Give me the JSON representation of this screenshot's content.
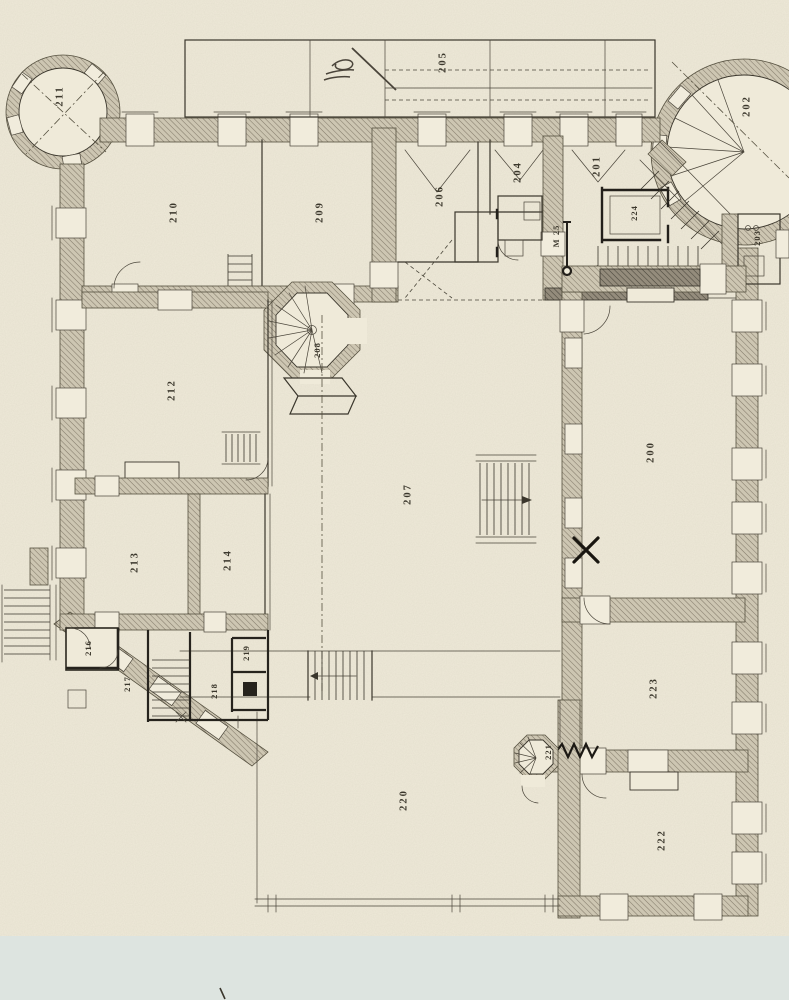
{
  "labels": {
    "r200": "200",
    "r201": "201",
    "r202": "202",
    "r203": "203",
    "r204": "204",
    "r205": "205",
    "r206": "206",
    "r207": "207",
    "r208": "208",
    "r209": "209",
    "r210": "210",
    "r211": "211",
    "r212": "212",
    "r213": "213",
    "r214": "214",
    "r216": "216",
    "r217": "217",
    "r218": "218",
    "r219": "219",
    "r220": "220",
    "r221": "221",
    "r222": "222",
    "r223": "223",
    "r224": "224"
  },
  "annotations": {
    "section_mark": "M 25"
  },
  "colors": {
    "paper": "#efead9",
    "ink": "#3a362c",
    "wall_hatch": "#cdc6b2",
    "wall_hatch_line": "#847c6b",
    "dark_ink": "#23201b",
    "scan_strip_bottom": "#dde4e0",
    "scan_strip_top": "#f6f4ec"
  }
}
